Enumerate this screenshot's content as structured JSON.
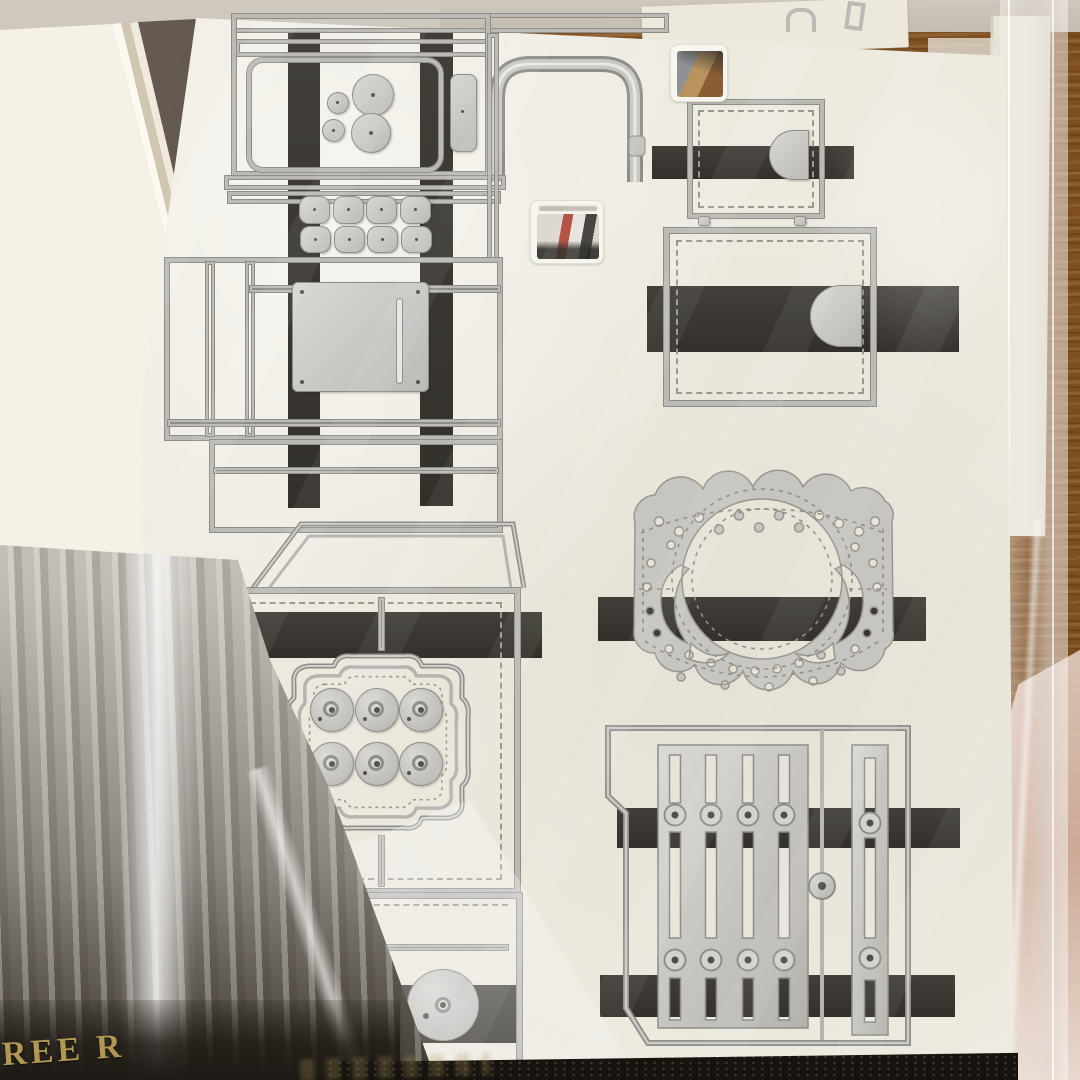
{
  "scene": {
    "description": "Close-up photo of silver metal craft cutting dies (box templates, pockets, scalloped doily, wheels and fence shapes) held by dark magnetic strips on cream backing sheets inside clear plastic sleeves, stacked on a wooden table",
    "subject": "metal-cutting-die-storage-sheets"
  },
  "packaging": {
    "visible_text": "REE R"
  },
  "stickers": {
    "count": 2
  },
  "colors": {
    "wood": "#96652f",
    "wood_dark": "#7a4c1f",
    "plastic": "#cdc7bd",
    "sheet": "#edeae0",
    "sheet_shade": "#ded9cc",
    "stack": "#f4f0e5",
    "stack_edge": "#d8d1bd",
    "gap": "#5d5348",
    "metal_light": "#d9d8d5",
    "metal_mid": "#bbbab7",
    "metal_dark": "#8e8d8a",
    "stitch": "#9a9893",
    "strip": "#3a3733",
    "cello_light": "#dedad3",
    "cello_dark": "#49433a",
    "package_dark": "#26221c",
    "gold": "#b09754",
    "pink_plastic": "#d9bdae",
    "bottom_dark": "#17140f"
  }
}
